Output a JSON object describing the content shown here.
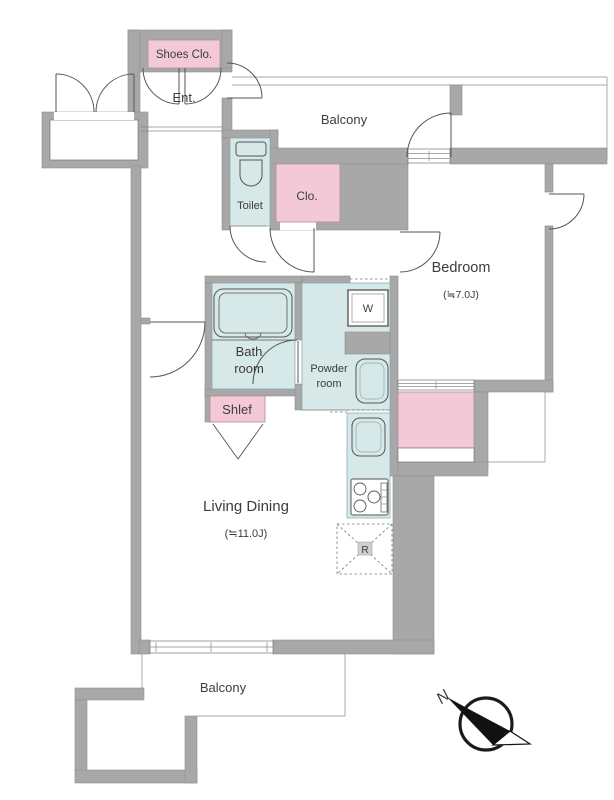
{
  "colors": {
    "wall": "#a8a8a8",
    "room_blue": "#d6e8e8",
    "room_pink": "#f3c9d7",
    "line": "#555555",
    "text": "#3c3c3c"
  },
  "labels": {
    "shoes_closet": "Shoes Clo.",
    "entrance": "Ent.",
    "balcony_top": "Balcony",
    "toilet": "Toilet",
    "closet": "Clo.",
    "bedroom": "Bedroom",
    "bedroom_size": "(≒7.0J)",
    "bath_line1": "Bath",
    "bath_line2": "room",
    "powder_line1": "Powder",
    "powder_line2": "room",
    "washer": "W",
    "shelf": "Shlef",
    "fridge": "R",
    "living": "Living Dining",
    "living_size": "(≒11.0J)",
    "balcony_bottom": "Balcony",
    "compass_north": "N"
  }
}
